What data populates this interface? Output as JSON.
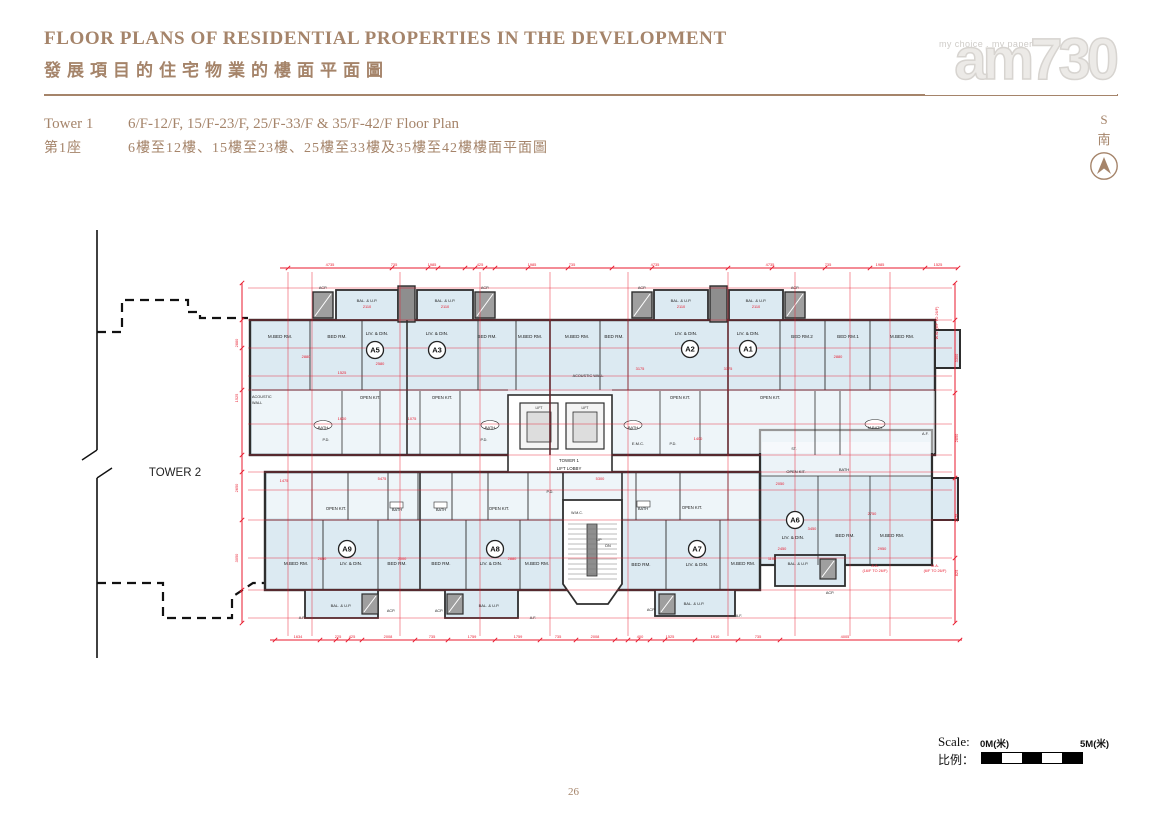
{
  "page": {
    "title_en": "FLOOR PLANS OF RESIDENTIAL PROPERTIES IN THE DEVELOPMENT",
    "title_zh": "發展項目的住宅物業的樓面平面圖",
    "page_number": "26"
  },
  "subheader": {
    "tower_en": "Tower 1",
    "tower_zh": "第1座",
    "floors_en": "6/F-12/F, 15/F-23/F, 25/F-33/F & 35/F-42/F Floor Plan",
    "floors_zh": "6樓至12樓、15樓至23樓、25樓至33樓及35樓至42樓樓面平面圖"
  },
  "logo": {
    "tagline": "my choice . my paper",
    "name": "am730"
  },
  "compass": {
    "letter": "S",
    "zh": "南"
  },
  "scale_bar": {
    "label_en": "Scale:",
    "label_zh": "比例：",
    "start": "0M(米)",
    "end": "5M(米)"
  },
  "colors": {
    "accent": "#a5846a",
    "dimension_red": "#e8192c",
    "room_fill": "#dceaf2",
    "wall": "#2e2e2e"
  },
  "floor_plan": {
    "units": [
      {
        "id": "A5",
        "x": 295,
        "y": 122
      },
      {
        "id": "A3",
        "x": 357,
        "y": 122
      },
      {
        "id": "A2",
        "x": 610,
        "y": 121
      },
      {
        "id": "A1",
        "x": 668,
        "y": 121
      },
      {
        "id": "A9",
        "x": 267,
        "y": 321
      },
      {
        "id": "A8",
        "x": 415,
        "y": 321
      },
      {
        "id": "A7",
        "x": 617,
        "y": 321
      },
      {
        "id": "A6",
        "x": 715,
        "y": 292
      }
    ],
    "room_labels": [
      {
        "t": "TOWER 2",
        "x": 95,
        "y": 248,
        "s": 11.5
      },
      {
        "t": "ACP.",
        "x": 243,
        "y": 61,
        "s": 3.8
      },
      {
        "t": "BAL. & U.P.",
        "x": 287,
        "y": 74,
        "s": 4
      },
      {
        "t": "BAL. & U.P.",
        "x": 365,
        "y": 74,
        "s": 4
      },
      {
        "t": "ACP.",
        "x": 405,
        "y": 61,
        "s": 3.8
      },
      {
        "t": "ACP.",
        "x": 562,
        "y": 61,
        "s": 3.8
      },
      {
        "t": "BAL. & U.P.",
        "x": 601,
        "y": 74,
        "s": 4
      },
      {
        "t": "BAL. & U.P.",
        "x": 676,
        "y": 74,
        "s": 4
      },
      {
        "t": "ACP.",
        "x": 715,
        "y": 61,
        "s": 3.8
      },
      {
        "t": "M.BED RM.",
        "x": 200,
        "y": 110
      },
      {
        "t": "BED RM.",
        "x": 257,
        "y": 110
      },
      {
        "t": "LIV. & DIN.",
        "x": 297,
        "y": 107
      },
      {
        "t": "LIV. & DIN.",
        "x": 357,
        "y": 107
      },
      {
        "t": "BED RM.",
        "x": 407,
        "y": 110
      },
      {
        "t": "M.BED RM.",
        "x": 450,
        "y": 110
      },
      {
        "t": "M.BED RM.",
        "x": 497,
        "y": 110
      },
      {
        "t": "BED RM.",
        "x": 534,
        "y": 110
      },
      {
        "t": "LIV. & DIN.",
        "x": 606,
        "y": 107
      },
      {
        "t": "LIV. & DIN.",
        "x": 668,
        "y": 107
      },
      {
        "t": "BED RM.2",
        "x": 722,
        "y": 110
      },
      {
        "t": "BED RM.1",
        "x": 768,
        "y": 110
      },
      {
        "t": "M.BED RM.",
        "x": 822,
        "y": 110
      },
      {
        "t": "ACOUSTIC",
        "x": 172,
        "y": 170,
        "a": "start",
        "s": 3.8
      },
      {
        "t": "WALL",
        "x": 172,
        "y": 176,
        "a": "start",
        "s": 3.8
      },
      {
        "t": "ACOUSTIC WALL",
        "x": 508,
        "y": 149,
        "s": 3.8
      },
      {
        "t": "OPEN KIT.",
        "x": 290,
        "y": 171,
        "s": 4.2
      },
      {
        "t": "OPEN KIT.",
        "x": 362,
        "y": 171,
        "s": 4.2
      },
      {
        "t": "OPEN KIT.",
        "x": 600,
        "y": 171,
        "s": 4.2
      },
      {
        "t": "OPEN KIT.",
        "x": 690,
        "y": 171,
        "s": 4.2
      },
      {
        "t": "BATH",
        "x": 243,
        "y": 201,
        "s": 4
      },
      {
        "t": "BATH",
        "x": 410,
        "y": 201,
        "s": 4
      },
      {
        "t": "BATH",
        "x": 553,
        "y": 201,
        "s": 4
      },
      {
        "t": "M.BATH",
        "x": 795,
        "y": 201,
        "s": 4
      },
      {
        "t": "P.D.",
        "x": 246,
        "y": 213,
        "s": 3.8
      },
      {
        "t": "P.D.",
        "x": 404,
        "y": 213,
        "s": 3.8
      },
      {
        "t": "E.M.C.",
        "x": 558,
        "y": 217,
        "s": 4
      },
      {
        "t": "P.D.",
        "x": 593,
        "y": 217,
        "s": 3.8
      },
      {
        "t": "ST.",
        "x": 714,
        "y": 222,
        "s": 3.6
      },
      {
        "t": "BATH",
        "x": 764,
        "y": 243,
        "s": 4
      },
      {
        "t": "OPEN KIT.",
        "x": 716,
        "y": 245,
        "s": 4
      },
      {
        "t": "A.F.",
        "x": 842,
        "y": 207,
        "a": "start",
        "s": 3.8
      },
      {
        "t": "LIFT",
        "x": 459,
        "y": 181,
        "s": 3.4
      },
      {
        "t": "LIFT",
        "x": 505,
        "y": 181,
        "s": 3.4
      },
      {
        "t": "TOWER 1",
        "x": 489,
        "y": 234,
        "s": 4.4
      },
      {
        "t": "LIFT LOBBY",
        "x": 489,
        "y": 242,
        "s": 4.4
      },
      {
        "t": "P.D.",
        "x": 470,
        "y": 265,
        "s": 3.8
      },
      {
        "t": "OPEN KIT.",
        "x": 256,
        "y": 282,
        "s": 4.2
      },
      {
        "t": "BATH",
        "x": 317,
        "y": 283,
        "s": 4
      },
      {
        "t": "BATH",
        "x": 361,
        "y": 283,
        "s": 4
      },
      {
        "t": "OPEN KIT.",
        "x": 419,
        "y": 282,
        "s": 4.2
      },
      {
        "t": "BATH",
        "x": 563,
        "y": 282,
        "s": 4
      },
      {
        "t": "OPEN KIT.",
        "x": 612,
        "y": 281,
        "s": 4.2
      },
      {
        "t": "W.M.C.",
        "x": 497,
        "y": 286,
        "s": 3.6
      },
      {
        "t": "UP",
        "x": 519,
        "y": 313,
        "s": 3.8
      },
      {
        "t": "DN",
        "x": 528,
        "y": 319,
        "s": 3.8
      },
      {
        "t": "M.BED RM.",
        "x": 216,
        "y": 337
      },
      {
        "t": "LIV. & DIN.",
        "x": 271,
        "y": 337
      },
      {
        "t": "BED RM.",
        "x": 317,
        "y": 337
      },
      {
        "t": "BED RM.",
        "x": 361,
        "y": 337
      },
      {
        "t": "LIV. & DIN.",
        "x": 411,
        "y": 337
      },
      {
        "t": "M.BED RM.",
        "x": 457,
        "y": 337
      },
      {
        "t": "BED RM.",
        "x": 561,
        "y": 338
      },
      {
        "t": "LIV. & DIN.",
        "x": 617,
        "y": 338
      },
      {
        "t": "M.BED RM.",
        "x": 663,
        "y": 337
      },
      {
        "t": "LIV. & DIN.",
        "x": 713,
        "y": 311
      },
      {
        "t": "BED RM.",
        "x": 765,
        "y": 309
      },
      {
        "t": "M.BED RM.",
        "x": 812,
        "y": 309
      },
      {
        "t": "BAL. & U.P.",
        "x": 718,
        "y": 337,
        "s": 4
      },
      {
        "t": "ACP.",
        "x": 750,
        "y": 366,
        "s": 3.8
      },
      {
        "t": "BAL. & U.P.",
        "x": 261,
        "y": 379,
        "s": 4
      },
      {
        "t": "ACP.",
        "x": 311,
        "y": 384,
        "s": 3.8
      },
      {
        "t": "A.F.",
        "x": 222,
        "y": 391,
        "s": 3.8
      },
      {
        "t": "ACP.",
        "x": 359,
        "y": 384,
        "s": 3.8
      },
      {
        "t": "BAL. & U.P.",
        "x": 409,
        "y": 379,
        "s": 4
      },
      {
        "t": "A.F.",
        "x": 453,
        "y": 391,
        "s": 3.8
      },
      {
        "t": "ACP.",
        "x": 571,
        "y": 383,
        "s": 3.8
      },
      {
        "t": "BAL. & U.P.",
        "x": 614,
        "y": 377,
        "s": 4
      },
      {
        "t": "A.F.",
        "x": 659,
        "y": 389,
        "s": 3.8
      }
    ],
    "red_labels": [
      {
        "t": "W.W. (6/F TO 26/F)",
        "x": 858,
        "y": 95,
        "r": -90
      },
      {
        "t": "A.A.",
        "x": 795,
        "y": 339
      },
      {
        "t": "(16/F TO 26/F)",
        "x": 795,
        "y": 344
      },
      {
        "t": "M.A.",
        "x": 855,
        "y": 339
      },
      {
        "t": "(6/F TO 26/F)",
        "x": 855,
        "y": 344
      }
    ],
    "dim_numbers": [
      {
        "t": "4735",
        "x": 250,
        "y": 38
      },
      {
        "t": "735",
        "x": 314,
        "y": 38
      },
      {
        "t": "1985",
        "x": 352,
        "y": 38
      },
      {
        "t": "425",
        "x": 400,
        "y": 38
      },
      {
        "t": "1985",
        "x": 452,
        "y": 38
      },
      {
        "t": "735",
        "x": 492,
        "y": 38
      },
      {
        "t": "4735",
        "x": 575,
        "y": 38
      },
      {
        "t": "4735",
        "x": 690,
        "y": 38
      },
      {
        "t": "735",
        "x": 748,
        "y": 38
      },
      {
        "t": "1985",
        "x": 800,
        "y": 38
      },
      {
        "t": "1525",
        "x": 858,
        "y": 38
      },
      {
        "t": "1634",
        "x": 218,
        "y": 410
      },
      {
        "t": "225",
        "x": 258,
        "y": 410
      },
      {
        "t": "425",
        "x": 272,
        "y": 410
      },
      {
        "t": "2008",
        "x": 308,
        "y": 410
      },
      {
        "t": "735",
        "x": 352,
        "y": 410
      },
      {
        "t": "1759",
        "x": 392,
        "y": 410
      },
      {
        "t": "1759",
        "x": 438,
        "y": 410
      },
      {
        "t": "735",
        "x": 478,
        "y": 410
      },
      {
        "t": "2008",
        "x": 515,
        "y": 410
      },
      {
        "t": "400",
        "x": 560,
        "y": 410
      },
      {
        "t": "1525",
        "x": 590,
        "y": 410
      },
      {
        "t": "1910",
        "x": 635,
        "y": 410
      },
      {
        "t": "735",
        "x": 678,
        "y": 410
      },
      {
        "t": "4005",
        "x": 765,
        "y": 410
      },
      {
        "t": "2880",
        "x": 158,
        "y": 115,
        "r": -90
      },
      {
        "t": "1525",
        "x": 158,
        "y": 170,
        "r": -90
      },
      {
        "t": "2650",
        "x": 158,
        "y": 260,
        "r": -90
      },
      {
        "t": "3050",
        "x": 158,
        "y": 330,
        "r": -90
      },
      {
        "t": "3300",
        "x": 878,
        "y": 130,
        "r": -90
      },
      {
        "t": "2850",
        "x": 878,
        "y": 210,
        "r": -90
      },
      {
        "t": "2575",
        "x": 878,
        "y": 290,
        "r": -90
      },
      {
        "t": "825",
        "x": 878,
        "y": 345,
        "r": -90
      },
      {
        "t": "2110",
        "x": 287,
        "y": 80
      },
      {
        "t": "2110",
        "x": 365,
        "y": 80
      },
      {
        "t": "2110",
        "x": 601,
        "y": 80
      },
      {
        "t": "2110",
        "x": 676,
        "y": 80
      },
      {
        "t": "2880",
        "x": 226,
        "y": 130
      },
      {
        "t": "2580",
        "x": 300,
        "y": 137
      },
      {
        "t": "1525",
        "x": 262,
        "y": 146
      },
      {
        "t": "2880",
        "x": 758,
        "y": 130
      },
      {
        "t": "3175",
        "x": 648,
        "y": 142
      },
      {
        "t": "3175",
        "x": 560,
        "y": 142
      },
      {
        "t": "1400",
        "x": 618,
        "y": 212
      },
      {
        "t": "2050",
        "x": 700,
        "y": 257
      },
      {
        "t": "5475",
        "x": 302,
        "y": 252
      },
      {
        "t": "1475",
        "x": 204,
        "y": 254
      },
      {
        "t": "2650",
        "x": 242,
        "y": 332
      },
      {
        "t": "2000",
        "x": 322,
        "y": 332
      },
      {
        "t": "2880",
        "x": 432,
        "y": 332
      },
      {
        "t": "3450",
        "x": 732,
        "y": 302
      },
      {
        "t": "2750",
        "x": 792,
        "y": 287
      },
      {
        "t": "2950",
        "x": 802,
        "y": 322
      },
      {
        "t": "2450",
        "x": 702,
        "y": 322
      },
      {
        "t": "1075",
        "x": 332,
        "y": 192
      },
      {
        "t": "1600",
        "x": 262,
        "y": 192
      },
      {
        "t": "5300",
        "x": 520,
        "y": 252
      },
      {
        "t": "1100",
        "x": 692,
        "y": 332
      }
    ],
    "ticks": {
      "top": [
        208,
        312,
        348,
        358,
        385,
        395,
        405,
        415,
        448,
        488,
        532,
        572,
        648,
        692,
        745,
        790,
        845,
        878
      ],
      "bottom": [
        195,
        240,
        256,
        268,
        282,
        335,
        368,
        415,
        460,
        496,
        535,
        548,
        558,
        570,
        585,
        615,
        658,
        700,
        880
      ],
      "left": [
        55,
        92,
        120,
        162,
        227,
        244,
        292,
        362,
        395
      ],
      "right": [
        55,
        92,
        165,
        250,
        330,
        395
      ]
    }
  }
}
